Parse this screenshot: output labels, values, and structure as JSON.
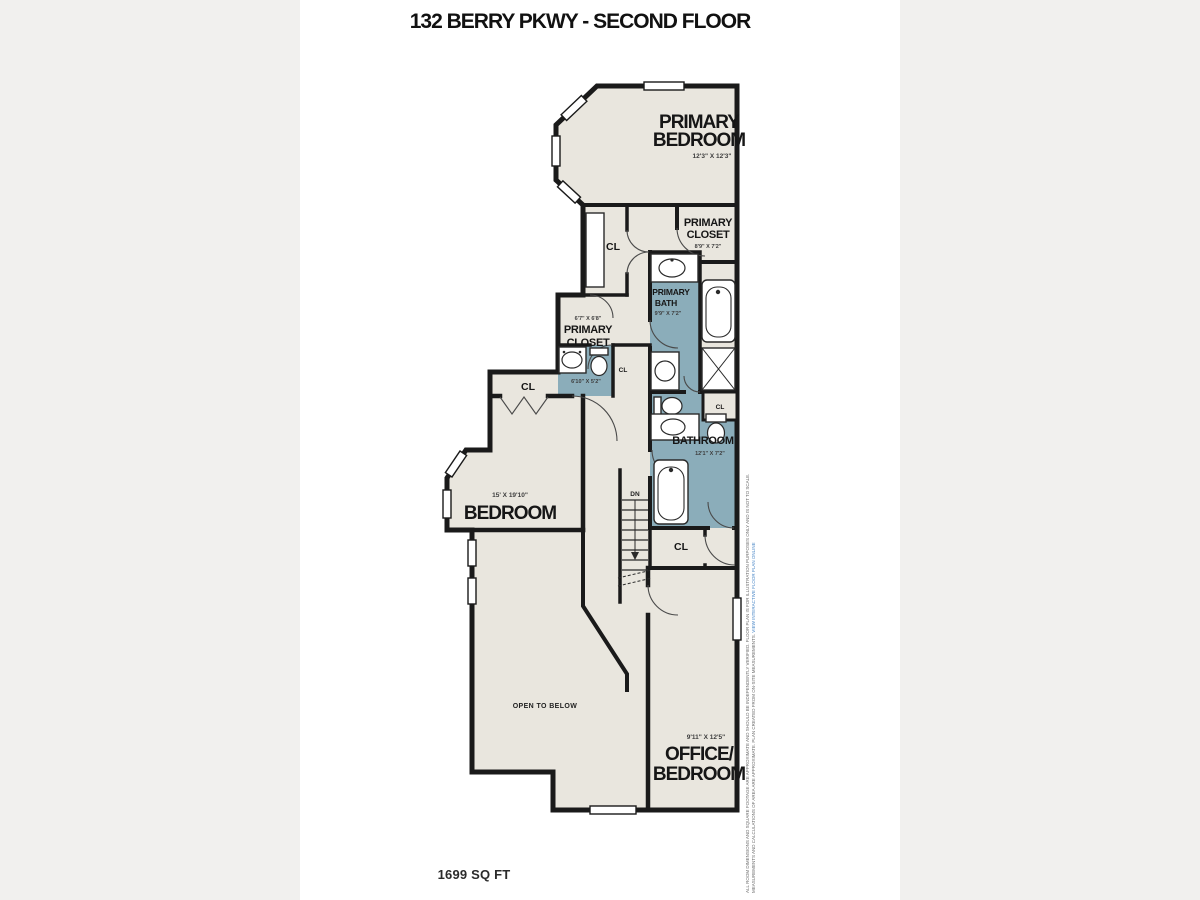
{
  "title": "132 BERRY PKWY - SECOND FLOOR",
  "area_label": "1699 SQ FT",
  "colors": {
    "floor": "#e9e6de",
    "bath_accent": "#8badba",
    "wall": "#1a1a1a",
    "sheet": "#ffffff",
    "margin": "#f1f0ee",
    "link_blue": "#4a87c7"
  },
  "labels": {
    "cl": "CL",
    "dn": "DN"
  },
  "rooms": {
    "primary_bedroom": {
      "line1": "PRIMARY",
      "line2": "BEDROOM",
      "dims": "12'3\" X 12'3\""
    },
    "primary_closet_right": {
      "line1": "PRIMARY",
      "line2": "CLOSET",
      "dims": "8'9\" X 7'2\""
    },
    "primary_bath": {
      "line1": "PRIMARY",
      "line2": "BATH",
      "dims": "9'9\" X 7'2\""
    },
    "primary_closet_left": {
      "line1": "PRIMARY",
      "line2": "CLOSET",
      "dims": "6'7\" X 6'8\""
    },
    "half_bath": {
      "dims": "6'10\" X 5'2\""
    },
    "bathroom": {
      "line1": "BATHROOM",
      "dims": "12'1\" X 7'2\""
    },
    "bedroom": {
      "line1": "BEDROOM",
      "dims": "15' X 19'10\""
    },
    "office_bedroom": {
      "line1": "OFFICE/",
      "line2": "BEDROOM",
      "dims": "9'11\" X 12'5\""
    },
    "open_below": {
      "line1": "OPEN TO BELOW"
    }
  },
  "watermark": {
    "line1": "ALL ROOM DIMENSIONS AND SQUARE FOOTAGE ARE APPROXIMATE AND SHOULD BE INDEPENDENTLY VERIFIED. FLOOR PLAN IS FOR ILLUSTRATION PURPOSES ONLY AND IS NOT TO SCALE.",
    "line2": "MEASUREMENTS AND CALCULATIONS OF AREA ARE APPROXIMATE. PLAN CREATED FROM ON-SITE MEASUREMENTS.",
    "link": "VIEW INTERACTIVE FLOOR PLAN ONLINE"
  }
}
